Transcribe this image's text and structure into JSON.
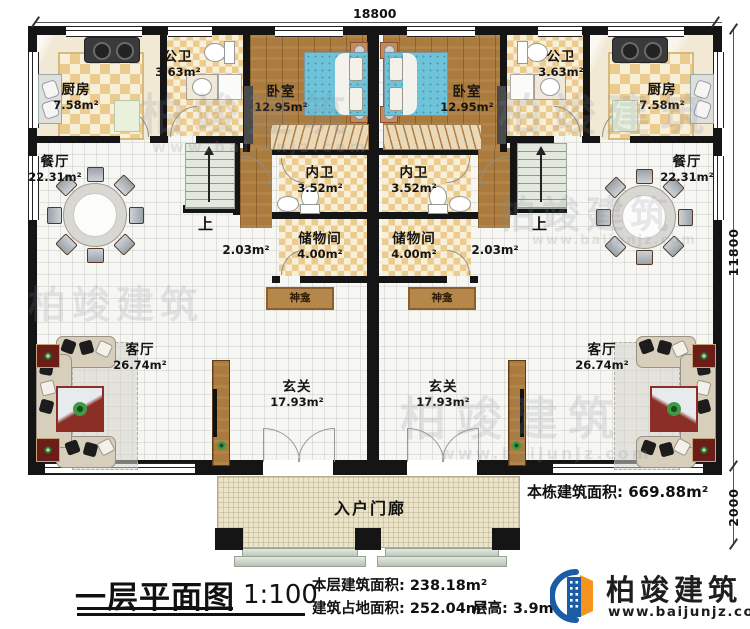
{
  "colors": {
    "wall": "#151515",
    "wood_floor": "#aa7b3c",
    "tile_dark": "#eccb8f",
    "tile_light": "#f8efd9",
    "bed_blue": "#6ec3d8",
    "brand_blue": "#1c5ca5",
    "brand_orange": "#f7941d",
    "watermark_grey": "#808a99"
  },
  "dims": {
    "top": "18800",
    "side": "11800",
    "porch": "2000"
  },
  "rooms": {
    "kitchen": {
      "name": "厨房",
      "area": "7.58m²"
    },
    "public_bath": {
      "name": "公卫",
      "area": "3.63m²"
    },
    "bedroom": {
      "name": "卧室",
      "area": "12.95m²"
    },
    "dining": {
      "name": "餐厅",
      "area": "22.31m²"
    },
    "inner_bath": {
      "name": "内卫",
      "area": "3.52m²"
    },
    "storage": {
      "name": "储物间",
      "area": "4.00m²"
    },
    "corridor_area": "2.03m²",
    "shrine": "神龛",
    "living": {
      "name": "客厅",
      "area": "26.74m²"
    },
    "foyer": {
      "name": "玄关",
      "area": "17.93m²"
    },
    "porch": "入户门廊",
    "stairs_up": "上"
  },
  "annotations": {
    "building_total": "本栋建筑面积: 669.88m²"
  },
  "titleblock": {
    "title": "一层平面图",
    "scale": "1:100",
    "floor_area": "本层建筑面积: 238.18m²",
    "footprint_area": "建筑占地面积: 252.04m²",
    "floor_height": "层高: 3.9m"
  },
  "brand": {
    "name": "柏竣建筑",
    "url": "www.baijunjz.com"
  },
  "watermark": {
    "text": "柏竣建筑",
    "url": "www.baijunjz.com"
  }
}
